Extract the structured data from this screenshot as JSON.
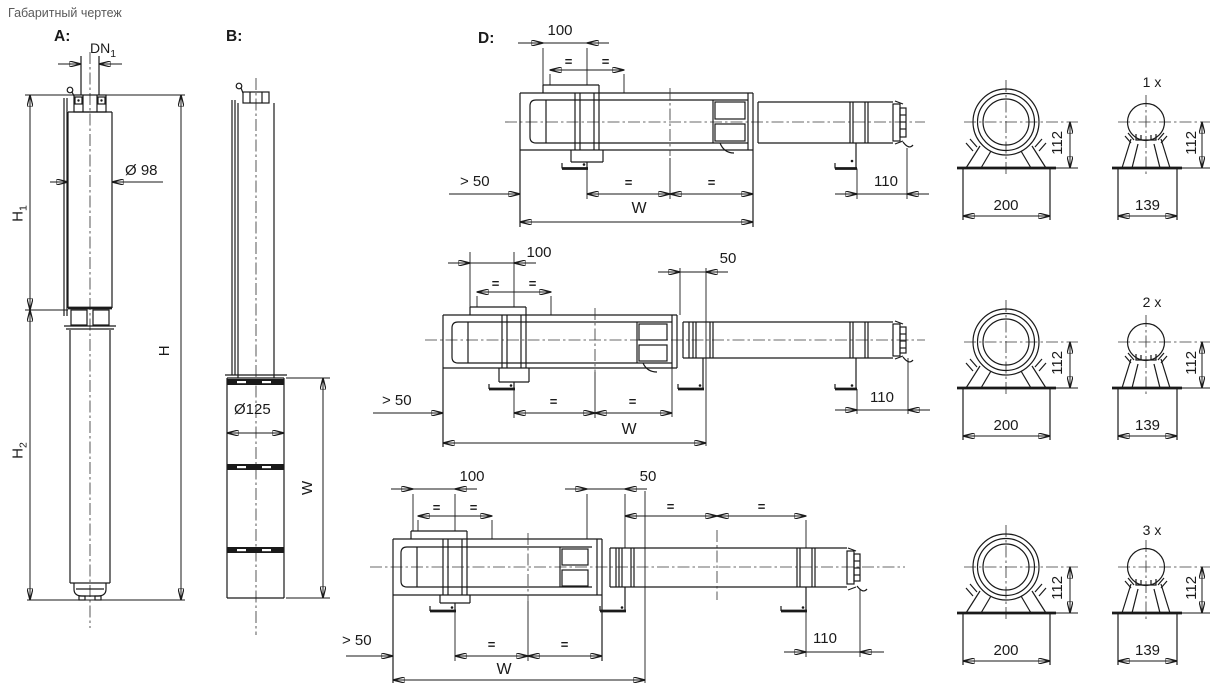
{
  "title": "Габаритный чертеж",
  "colors": {
    "line": "#1a1a1a",
    "title_text": "#5a5a5a",
    "background": "#ffffff"
  },
  "views": {
    "a": {
      "label": "A:",
      "dims": {
        "dn": "DN",
        "dn_sub": "1",
        "diameter": "Ø 98",
        "h1": "H",
        "h1_sub": "1",
        "h2": "H",
        "h2_sub": "2",
        "h_total": "H"
      }
    },
    "b": {
      "label": "B:",
      "dims": {
        "diameter": "Ø125",
        "width": "W"
      }
    },
    "d": {
      "label": "D:",
      "dims": {
        "clearance": "> 50",
        "pipe_offset": "100",
        "gap": "50",
        "equal": "=",
        "width": "W",
        "motor_overhang": "110",
        "axis_height": "112",
        "base_width_shroud": "200",
        "base_width_motor": "139"
      },
      "rows": [
        {
          "count": "1 x"
        },
        {
          "count": "2 x"
        },
        {
          "count": "3 x"
        }
      ]
    }
  }
}
